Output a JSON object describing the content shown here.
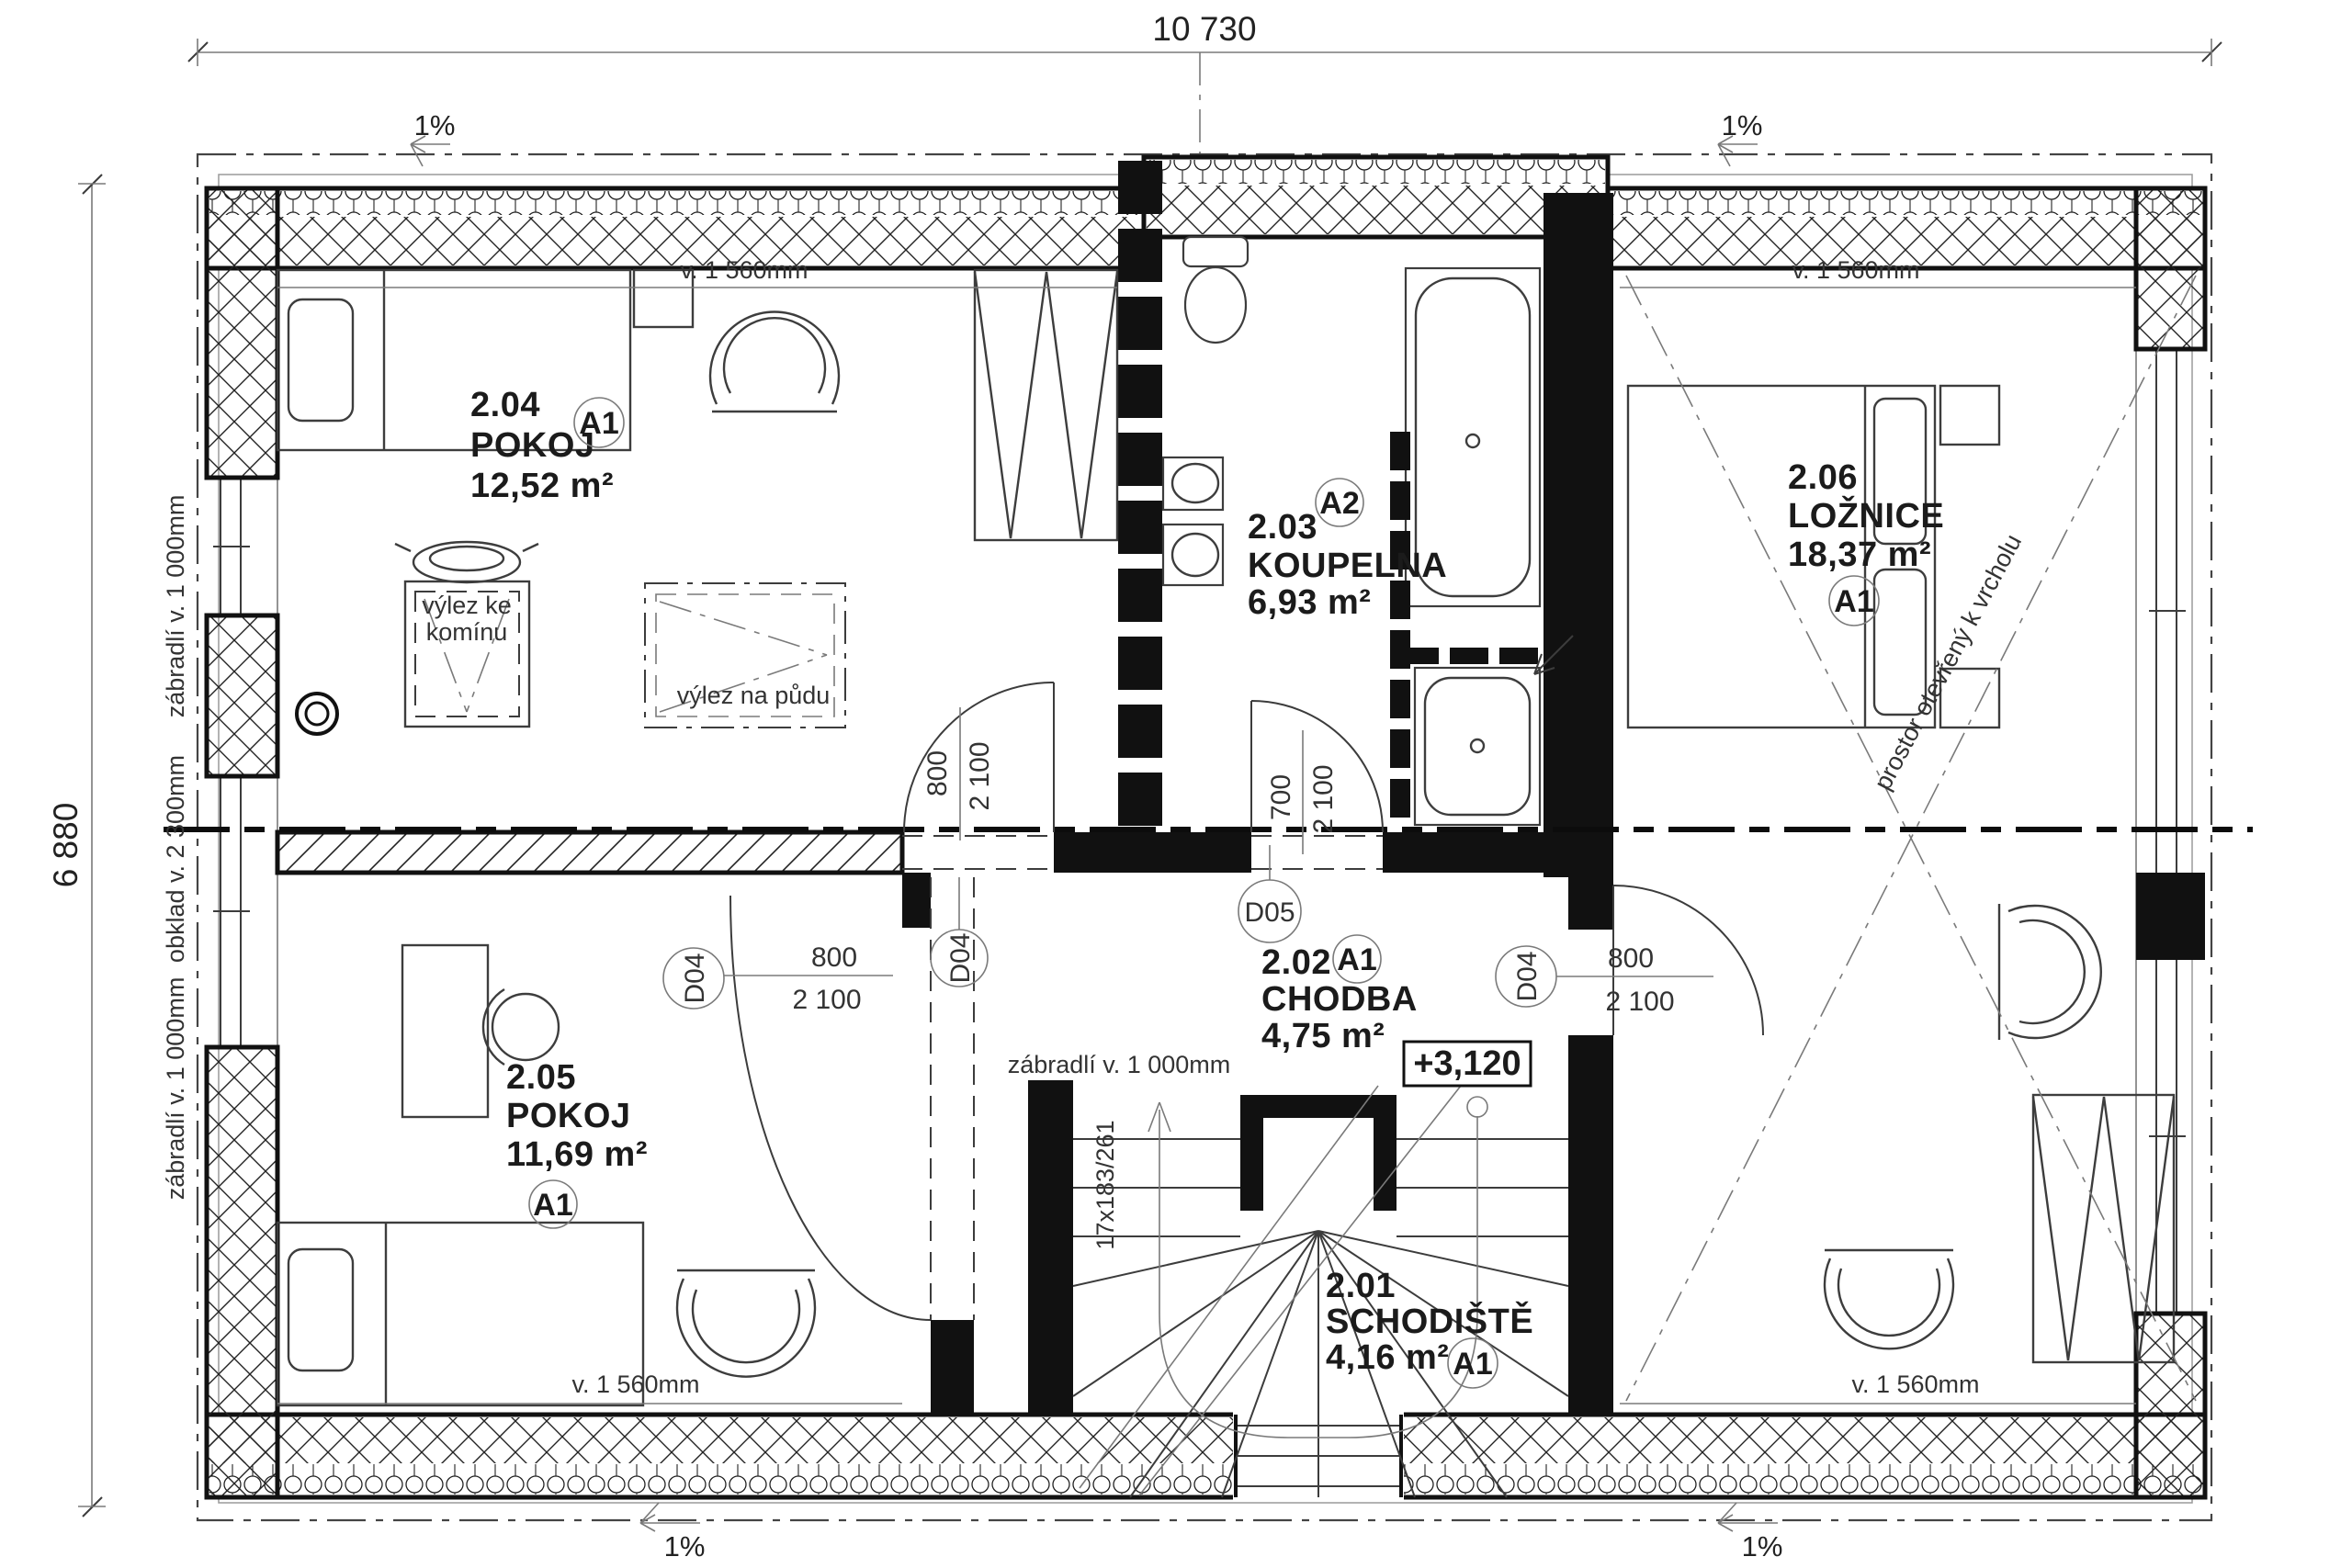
{
  "dimensions": {
    "overall_width": "10 730",
    "overall_height": "6 880"
  },
  "slope": {
    "label": "1%"
  },
  "rooms": [
    {
      "id": "2.04",
      "name": "POKOJ",
      "area": "12,52 m²",
      "finish": "A1"
    },
    {
      "id": "2.05",
      "name": "POKOJ",
      "area": "11,69 m²",
      "finish": "A1"
    },
    {
      "id": "2.03",
      "name": "KOUPELNA",
      "area": "6,93 m²",
      "finish": "A2"
    },
    {
      "id": "2.02",
      "name": "CHODBA",
      "area": "4,75 m²",
      "finish": "A1"
    },
    {
      "id": "2.01",
      "name": "SCHODIŠTĚ",
      "area": "4,16 m²",
      "finish": "A1"
    },
    {
      "id": "2.06",
      "name": "LOŽNICE",
      "area": "18,37 m²",
      "finish": "A1"
    }
  ],
  "doors": {
    "d04": "D04",
    "d05": "D05",
    "w800": "800",
    "w700": "700",
    "h2100": "2 100"
  },
  "annotations": {
    "knee_height": "v. 1 560mm",
    "railing": "zábradlí v. 1 000mm",
    "cladding": "obklad v. 2 300mm",
    "chimney_line1": "výlez ke",
    "chimney_line2": "komínu",
    "attic_hatch": "výlez na půdu",
    "open_space": "prostor otevřený k vrcholu",
    "level": "+3,120",
    "stair_spec": "17x183/261"
  }
}
